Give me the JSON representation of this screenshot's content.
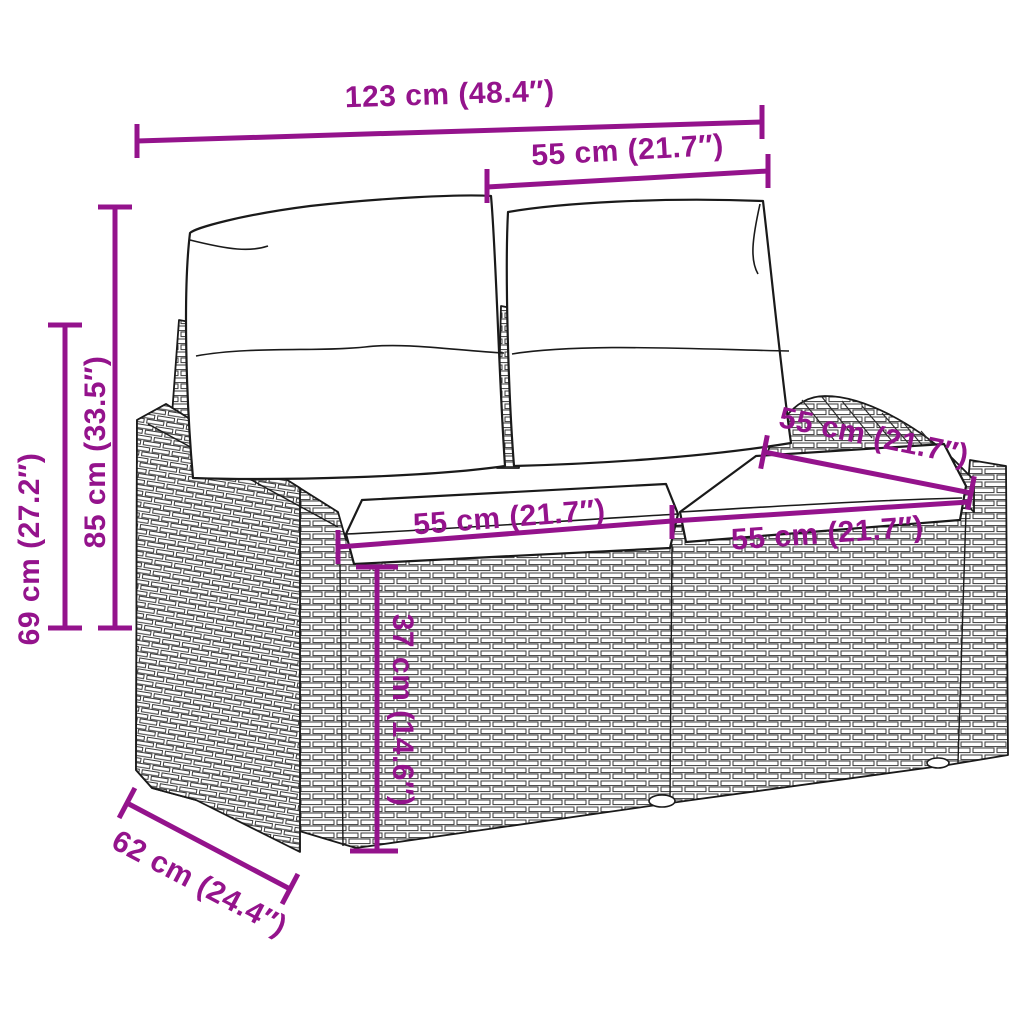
{
  "diagram": {
    "type": "product-dimension-diagram",
    "subject": "poly-rattan garden 2-seater sofa with back and seat cushions",
    "accent_color": "#94138C",
    "line_color": "#1a1a1a",
    "background_color": "#ffffff",
    "dimensions": {
      "total_width": "123 cm (48.4″)",
      "back_cushion_width": "55 cm (21.7″)",
      "total_height": "85 cm (33.5″)",
      "armrest_height": "69 cm (27.2″)",
      "seat_depth": "55 cm (21.7″)",
      "seat_width_left": "55 cm (21.7″)",
      "seat_width_right": "55 cm (21.7″)",
      "seat_height": "37 cm (14.6″)",
      "total_depth": "62 cm (24.4″)"
    }
  }
}
